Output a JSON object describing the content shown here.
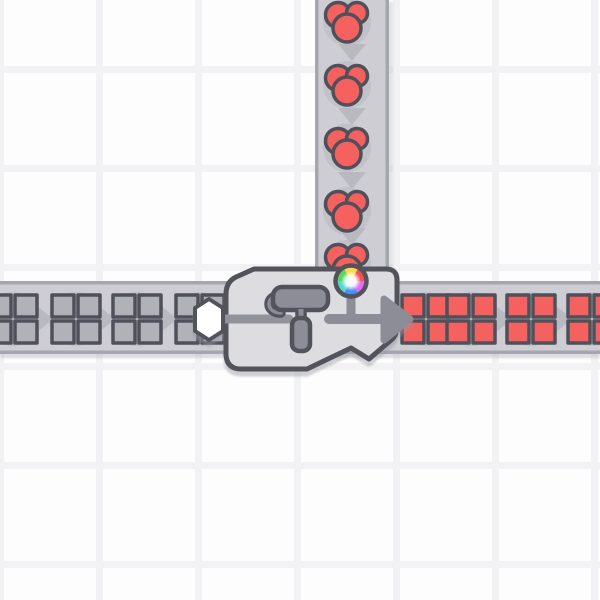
{
  "meta": {
    "scene_type": "factory-game-conveyor-scene",
    "machine_type": "painter",
    "visible_text": ""
  },
  "canvas": {
    "width": 600,
    "height": 600
  },
  "colors": {
    "background": "#fdfdfd",
    "grid_line": "#f2f2f5",
    "belt_fill": "#cdcdd3",
    "belt_edge": "#a6a6af",
    "chevron": "#b9b9c1",
    "item_shadow": "#bcbcc3",
    "outline": "#50505a",
    "machine_fill": "#dcdce1",
    "machine_outline": "#53535c",
    "red_item": "#f5615e",
    "gray_item": "#b1b1b8",
    "icon_gray": "#8d8d97",
    "line_gray": "#92929b",
    "hexagon_fill": "#ffffff",
    "wheel_sector_colors": [
      "#ffd84d",
      "#f3504d",
      "#e06cf0",
      "#4f8df5",
      "#52d9d3",
      "#58d65a"
    ]
  },
  "grid": {
    "cell": 99,
    "line_width": 7,
    "offset_x": -3,
    "offset_y": 66
  },
  "belts": {
    "horizontal": {
      "y": 281,
      "height": 73,
      "edge": 3.5,
      "direction": "right",
      "chevrons_x": [
        44,
        106,
        168,
        448,
        503,
        563
      ],
      "item_y": 319
    },
    "vertical": {
      "x": 315,
      "width": 74,
      "edge": 3.5,
      "direction": "down",
      "end_y": 312,
      "chevrons_y": [
        -6,
        52,
        116,
        180,
        236
      ],
      "item_x": 347
    }
  },
  "items": {
    "square_size": 49,
    "gray_squares_x": [
      13,
      76,
      137,
      200
    ],
    "red_squares_x": [
      426,
      471,
      531,
      592
    ],
    "squares_y": 319,
    "berries": {
      "x": 347,
      "ys": [
        22,
        85,
        148,
        211,
        264
      ]
    },
    "shadow_radius_square": 27,
    "shadow_radius_berry": 24
  },
  "machine": {
    "type": "painter",
    "body_path": "M 226 294 Q 226 282 236 277 L 254 269 L 386 269 Q 397 269 397 280 L 397 326 Q 397 336 390 341 L 369 359 L 351 348 L 307 369 L 241 369 Q 227 369 226 355 Z",
    "hexagon_points": "209,299 223,308 223,331 209,340 195,331 195,308",
    "input_line": [
      221,
      319,
      289,
      319
    ],
    "roller": {
      "body": [
        273,
        287,
        55,
        23
      ],
      "curl": "M 281 295 C 265 295 265 313 281 313",
      "neck": [
        301,
        309,
        301,
        321
      ],
      "handle": [
        292,
        318,
        18,
        33
      ]
    },
    "output": {
      "line": [
        329,
        319,
        385,
        319
      ],
      "head": "M 384 299 L 410 319 L 384 340 Z"
    },
    "wheel": {
      "cx": 351,
      "cy": 281,
      "r": 15.5,
      "stem": [
        351,
        293,
        351,
        319
      ],
      "white_center_r": 10
    }
  }
}
